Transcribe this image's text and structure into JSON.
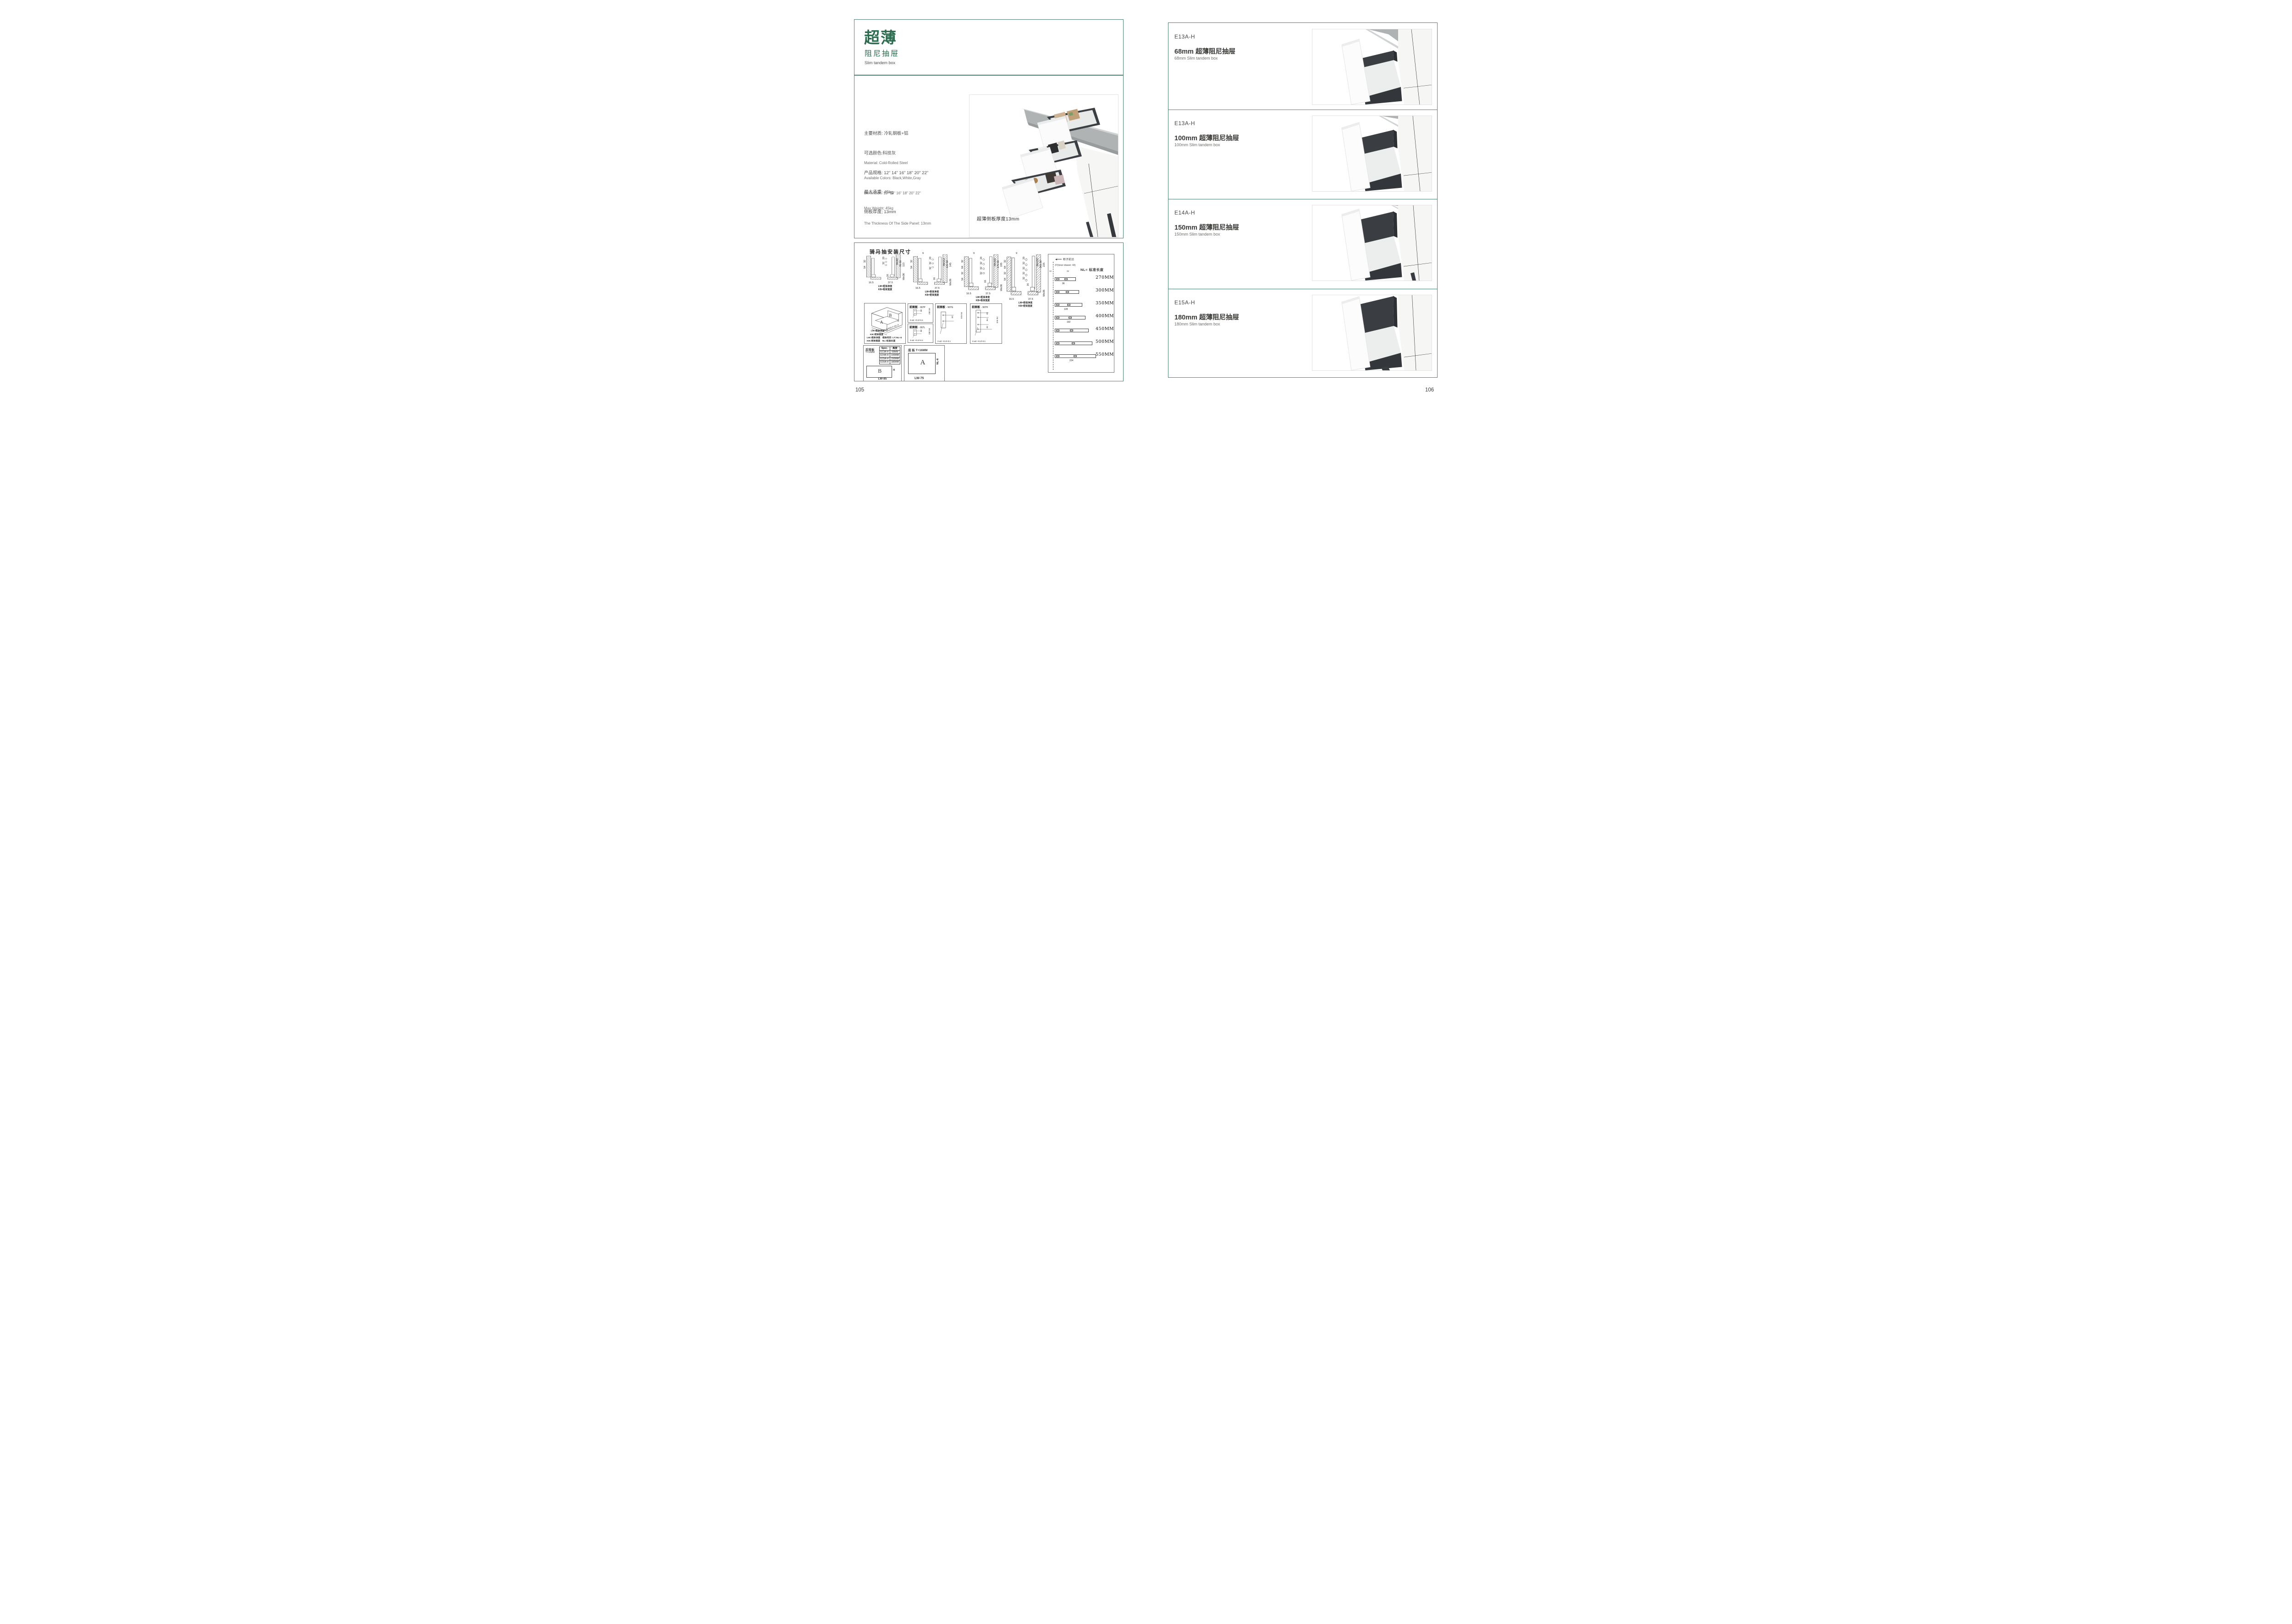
{
  "colors": {
    "accent_green": "#2b6e4f",
    "border_teal": "#4e7f73",
    "text_dark": "#3b3937",
    "text_gray": "#6c6a68",
    "drawer_dark": "#3b3f43",
    "counter_gray": "#b1b4b5"
  },
  "page_left": {
    "page_number": "105",
    "header": {
      "title_cn": "超薄",
      "subtitle_cn": "阻尼抽屉",
      "subtitle_en": "Slim tandem box"
    },
    "specs_cn": [
      "主要材质: 冷轧钢板+铝",
      "可选颜色:科技灰",
      "产品规格: 12\" 14\" 16\" 18\" 20\" 22\"",
      "最大承重: 45kg",
      "侧板厚度; 13mm"
    ],
    "specs_en": [
      "Material: Cold-Rolled Steel",
      "Available Colors: Black,White,Gray",
      "Dimension: 12\" 14\" 16\" 18\" 20\" 22\"",
      "Max Weight: 45kg",
      "The Thickness Of The Side Panel: 13mm"
    ],
    "photo_caption": "超薄侧板厚度13mm",
    "drawings": {
      "title": "骑马抽安装尺寸",
      "cross_sections": [
        {
          "top": "9",
          "inner": [
            "20",
            "32"
          ],
          "left": [
            "32",
            "54"
          ],
          "mid": "16",
          "right": [
            "Min82",
            "91.50",
            "113"
          ],
          "min36": "Min36",
          "b1": "16.5",
          "b2": "37.5",
          "lw": "LW=柜体净宽",
          "kb": "KB=柜体宽度"
        },
        {
          "top": "9",
          "inner": [
            "20",
            "32",
            "32"
          ],
          "left": [
            "32",
            "54"
          ],
          "mid": "16",
          "right": [
            "Min112",
            "121.50",
            "145"
          ],
          "min36": "Min36",
          "b1": "16.5",
          "b2": "37.5",
          "lw": "LW=柜体净宽",
          "kb": "KB=柜体宽度"
        },
        {
          "top": "9",
          "inner": [
            "20",
            "32",
            "32",
            "32"
          ],
          "left": [
            "32",
            "64",
            "32",
            "54"
          ],
          "mid": "16",
          "right": [
            "Min162",
            "171.50",
            "195"
          ],
          "min36": "Min36",
          "b1": "16.5",
          "b2": "37.5",
          "lw": "LW=柜体净宽",
          "kb": "KB=柜体宽度"
        },
        {
          "top": "9",
          "inner": [
            "20",
            "32",
            "32",
            "32",
            "32"
          ],
          "left": [
            "32",
            "64",
            "32",
            "54"
          ],
          "mid": "16",
          "right": [
            "Min192",
            "201.50",
            "225"
          ],
          "min36": "Min36",
          "b1": "16.5",
          "b2": "37.5",
          "lw": "LW=柜体净宽",
          "kb": "KB=柜体宽度"
        }
      ],
      "iso": {
        "letter_a": "A",
        "letter_b": "B",
        "dim_lw": "LW=柜体净宽",
        "dim_kb": "KB=柜体宽度",
        "dim_lt": "柜体内空LT=NL+3",
        "legend1": "LW=柜体净宽",
        "legend2": "柜体内空: LT=NL+3",
        "legend3": "KB=柜体宽度",
        "legend4": "NL=标准长度"
      },
      "front_panels": [
        {
          "name": "前面板",
          "code": "- 907P",
          "d1": "32",
          "min": "min 54",
          "leader": "2-ø2 +0.2/-0.1"
        },
        {
          "name": "前面板",
          "code": "- 907L",
          "d1": "32",
          "min": "min 54",
          "leader": "2-ø2 +0.2/-0.1"
        },
        {
          "name": "前面板",
          "code": "- 907G",
          "d1": "32",
          "min": "min 54",
          "leader": "2-ø2 +0.2/-0.1"
        },
        {
          "name": "前面板",
          "code": "- 907H",
          "d1": "32",
          "d2": "64",
          "d3": "32",
          "min": "min 54",
          "leader": "4-ø2 +0.2/-0.1"
        }
      ],
      "back_panel_box": {
        "title": "后背板",
        "thickness": "T=16MM",
        "table": {
          "h1": "Spec.",
          "h2": "高度",
          "rows": [
            [
              "E13A-H",
              "68MM"
            ],
            [
              "E14A-H",
              "100MM"
            ],
            [
              "E15A-H",
              "150MM"
            ],
            [
              "E16A-H",
              "180MM"
            ]
          ]
        },
        "letter": "B",
        "h_label": "H",
        "w_label": "LW-85"
      },
      "bottom_panel_box": {
        "title": "底 板 T=16MM",
        "letter": "A",
        "h_label": "NL-6",
        "w_label": "LW-75"
      },
      "nl_box": {
        "front_edge": "柜子前沿",
        "inner_note": "37(Inner drawer: 43)",
        "d32a": "32",
        "d32b": "32",
        "nl_label": "NL= 标准长度",
        "sizes": [
          "270MM",
          "300MM",
          "350MM",
          "400MM",
          "450MM",
          "500MM",
          "550MM"
        ],
        "dim96": "96",
        "dim128": "128",
        "dim192": "192",
        "dim224": "224"
      }
    }
  },
  "page_right": {
    "page_number": "106",
    "sections": [
      {
        "code": "E13A-H",
        "title_cn": "68mm 超薄阻尼抽屉",
        "title_en": "68mm Slim tandem box"
      },
      {
        "code": "E13A-H",
        "title_cn": "100mm 超薄阻尼抽屉",
        "title_en": "100mm Slim tandem box"
      },
      {
        "code": "E14A-H",
        "title_cn": "150mm 超薄阻尼抽屉",
        "title_en": "150mm Slim tandem box"
      },
      {
        "code": "E15A-H",
        "title_cn": "180mm 超薄阻尼抽屉",
        "title_en": "180mm Slim tandem box"
      }
    ]
  }
}
